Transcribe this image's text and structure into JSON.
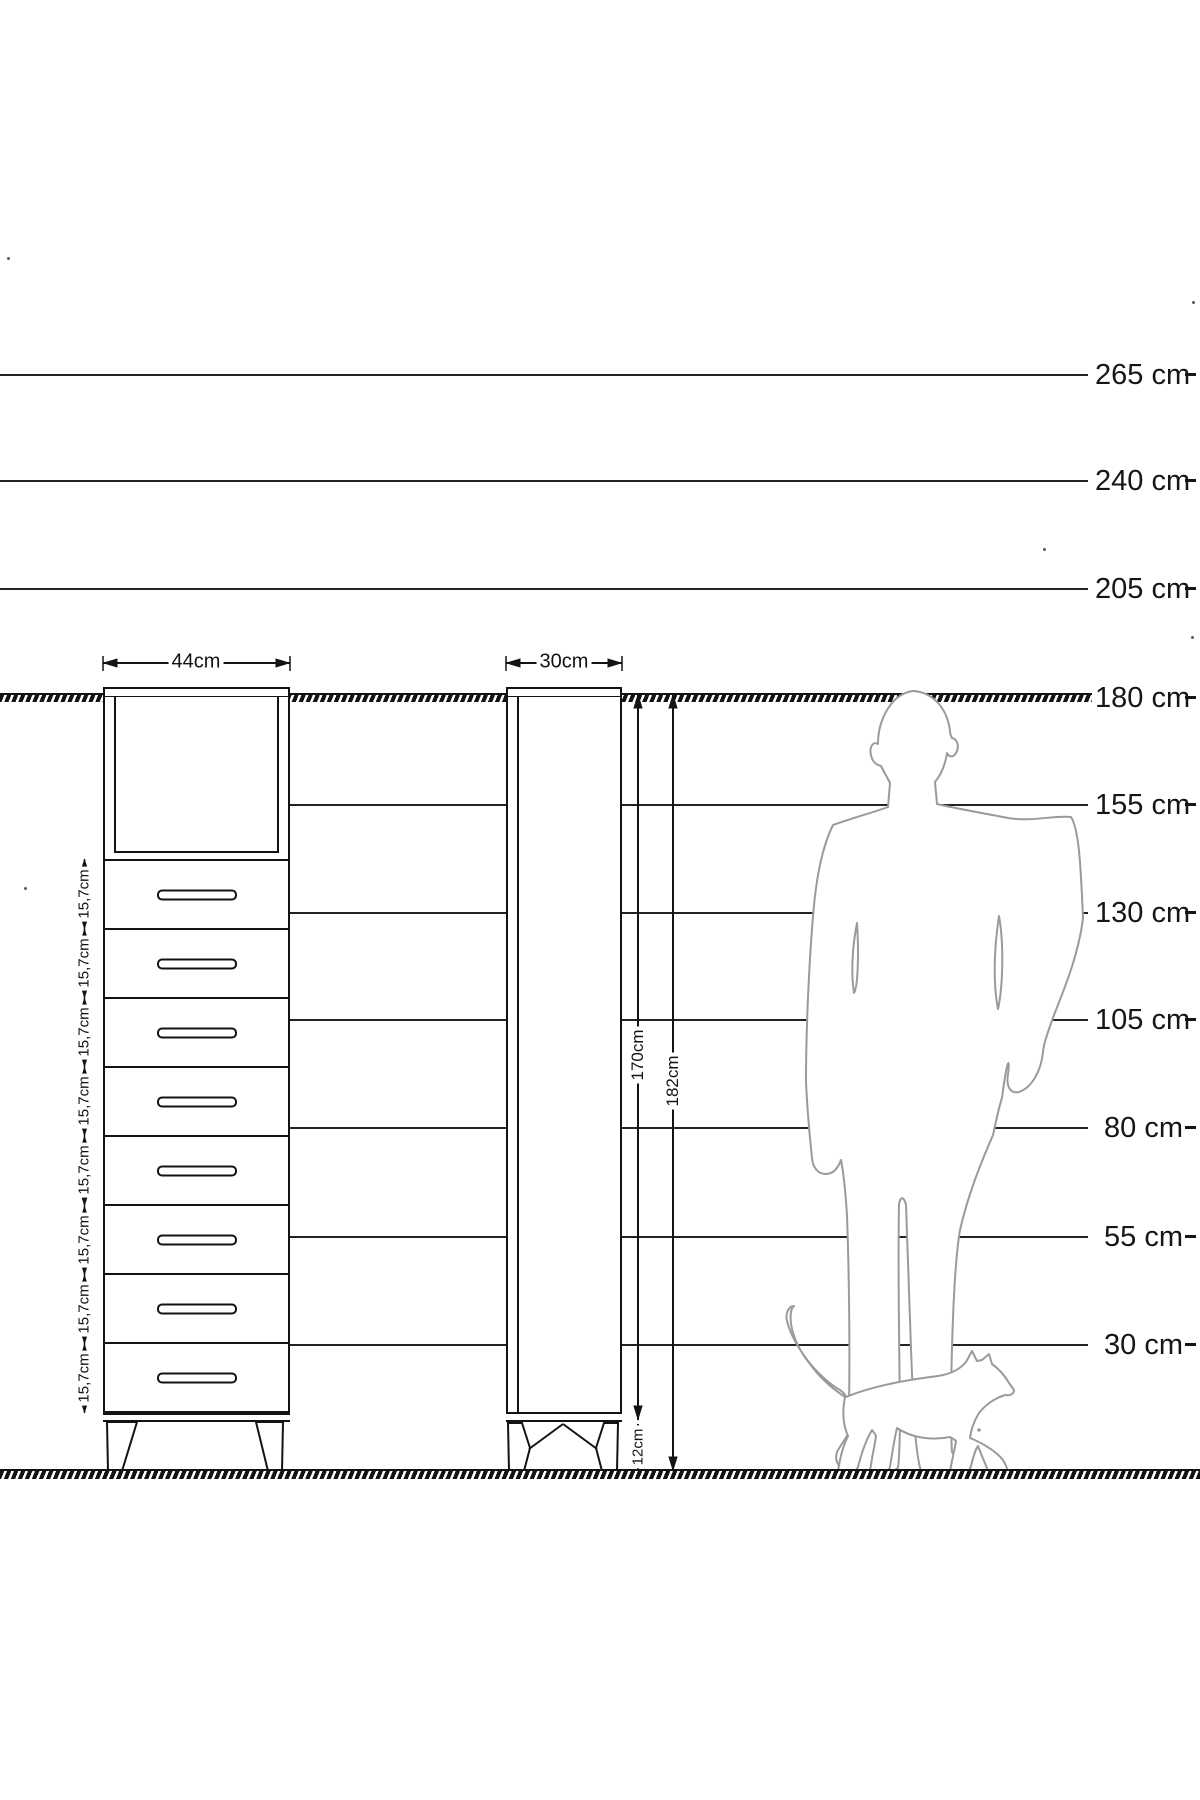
{
  "scale_labels": [
    "265 cm",
    "240 cm",
    "205 cm",
    "180 cm",
    "155 cm",
    "130 cm",
    "105 cm",
    "80 cm",
    "55 cm",
    "30 cm"
  ],
  "front_view": {
    "width_label": "44cm",
    "drawer_dims": [
      "15,7cm",
      "15,7cm",
      "15,7cm",
      "15,7cm",
      "15,7cm",
      "15,7cm",
      "15,7cm",
      "15,7cm"
    ]
  },
  "side_view": {
    "width_label": "30cm",
    "body_height_label": "170cm",
    "total_height_label": "182cm",
    "leg_height_label": "12cm"
  },
  "figures": {
    "man_icon": "man-silhouette",
    "cat_icon": "cat-silhouette"
  },
  "colors": {
    "line": "#131313",
    "silhouette": "#9a9a9a",
    "background": "#ffffff"
  }
}
